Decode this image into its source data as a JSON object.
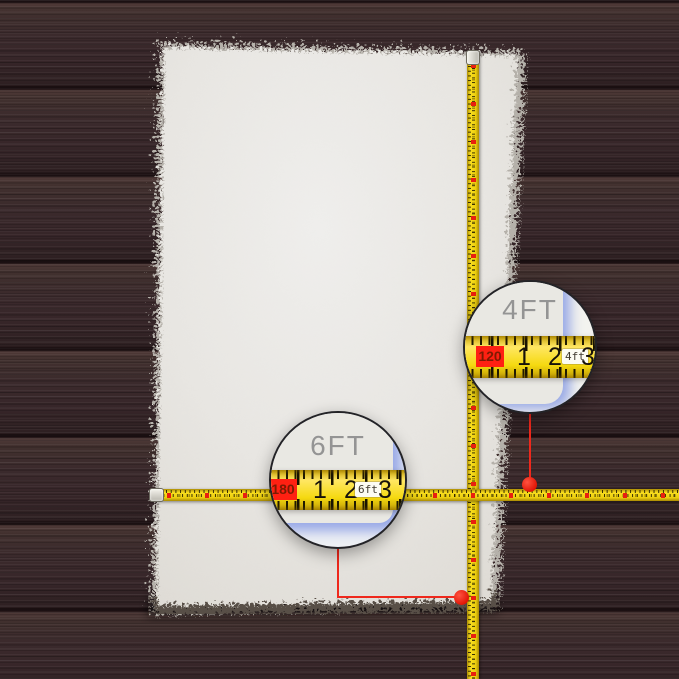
{
  "callouts": {
    "width": {
      "label": "4FT",
      "tape_start": "120",
      "ticks": [
        "1",
        "2",
        "3"
      ],
      "unit": "4ft"
    },
    "length": {
      "label": "6FT",
      "tape_start": "180",
      "ticks": [
        "1",
        "2",
        "3"
      ],
      "unit": "6ft"
    }
  },
  "colors": {
    "wood_plank": "#3b2a2c",
    "plank_gap": "#190e10",
    "rug": "#e9e7e2",
    "rug_fringe": "#b5b1aa",
    "tape_yellow": "#f5d90f",
    "tape_tick": "#201a00",
    "tape_marker_red": "#e8200f",
    "badge_red": "#ff2012",
    "badge_text": "#7d1a02",
    "callout_label_gray": "#949494",
    "magnified_edge_shadow_blue": "#b4c0ea",
    "connector_red": "#ef281c",
    "circle_border": "#232327"
  }
}
